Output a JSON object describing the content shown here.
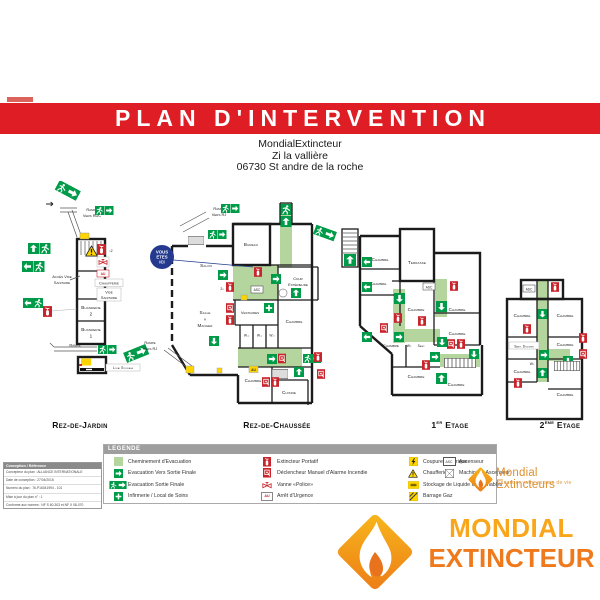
{
  "banner": {
    "title": "PLAN D'INTERVENTION"
  },
  "address": {
    "line1": "MondialExtincteur",
    "line2": "Zi la vallière",
    "line3": "06730 St andre de la roche"
  },
  "here": {
    "l1": "VOUS",
    "l2": "ETES",
    "l3": "ICI"
  },
  "markers": {
    "au": "AU",
    "asc": "ASC",
    "x2": "x2",
    "twox": "2x",
    "wc": "W.c"
  },
  "floors": [
    {
      "title": "Rez-de-Jardin",
      "rooms": {
        "ramp1": "Rampe",
        "ramp2": "Vers RDC",
        "acces1": "Accès Vide",
        "acces2": "Sanitaire",
        "chaufferie": "Chaufferie",
        "vide1": "Vide",
        "vide2": "Sanitaire",
        "buanderie": "Buanderie",
        "n2": "2",
        "n1": "1",
        "rampe": "Rampe",
        "stockage": "Local Stockage"
      }
    },
    {
      "title": "Rez-de-Chaussée",
      "rooms": {
        "ramp1": "Rampe",
        "ramp2": "Vers RJ",
        "bureau": "Bureau",
        "salon": "Salon",
        "cour1": "Cour",
        "cour2": "Extérieure",
        "vestiaires": "Vestiaires",
        "chambre": "Chambre",
        "salle1": "Salle",
        "salle2": "à",
        "salle3": "Manger",
        "cuisine": "Cuisine",
        "asc": "ASC"
      }
    },
    {
      "title_num": "1",
      "title_sup": "er",
      "title_rest": " Etage",
      "rooms": {
        "chambre": "Chambre",
        "terrasse": "Terrasse",
        "asc": "ASC",
        "wc": "Wc",
        "sanit": "Sanit."
      }
    },
    {
      "title_num": "2",
      "title_sup": "ème",
      "title_rest": " Etage",
      "rooms": {
        "chambre": "Chambre",
        "sanit": "Sanit. Douches",
        "asc": "ASC",
        "wc": "Wc"
      }
    }
  ],
  "legend": {
    "header": "LEGENDE",
    "columns": [
      [
        {
          "icon": "evacuation-path-swatch",
          "label": "Cheminement d'Evacuation"
        },
        {
          "icon": "evacuation-arrow",
          "label": "Evacuation Vers Sortie Finale"
        },
        {
          "icon": "evacuation-final-exit",
          "label": "Evacuation Sortie Finale"
        },
        {
          "icon": "first-aid-cross",
          "label": "Infirmerie / Local de Soins"
        }
      ],
      [
        {
          "icon": "portable-extinguisher",
          "label": "Extincteur Portatif"
        },
        {
          "icon": "manual-fire-alarm",
          "label": "Déclencheur Manuel d'Alarme Incendie"
        },
        {
          "icon": "police-valve",
          "label": "Vanne «Police»"
        },
        {
          "icon": "emergency-stop",
          "label": "Arrêt d'Urgence",
          "icon_text": "AU"
        }
      ],
      [
        {
          "icon": "power-cut",
          "label": "Coupure Electrique"
        },
        {
          "icon": "boiler-room-warning",
          "label": "Chaufferie"
        },
        {
          "icon": "flammable-liquid-storage",
          "label": "Stockage de Liquide Inflammables"
        },
        {
          "icon": "gas-shutoff",
          "label": "Barrage Gaz"
        }
      ],
      [
        {
          "icon": "elevator",
          "label": "Ascenseur",
          "icon_text": "ASC"
        },
        {
          "icon": "elevator-machinery",
          "label": "Machinerie Ascenseur"
        }
      ]
    ]
  },
  "info_box": {
    "header": "Conception / Référence",
    "lines": [
      "Concepteur du plan : ALLIANCE INTERNATIONALE",
      "Date de conception : 27/04/2016",
      "Numéro du plan : 76-P16041994 - 101",
      "Mise à jour du plan n° : 1",
      "Conforme aux normes : NF S 60-303 et NF X 08-070"
    ]
  },
  "brand_small": {
    "name": "Mondial Extincteurs",
    "tagline": "Sécuriser votre espace de vie"
  },
  "brand_large": {
    "word1": "MONDIAL",
    "word2": "EXTINCTEUR"
  },
  "colors": {
    "banner_red": "#de1e24",
    "safety_green": "#009b48",
    "path_green": "#b5d59e",
    "fire_red": "#c8242b",
    "warning_yellow": "#ffd500",
    "here_blue": "#233a8f",
    "logo_yellow": "#f9a61b",
    "logo_orange": "#ef7a1d"
  }
}
